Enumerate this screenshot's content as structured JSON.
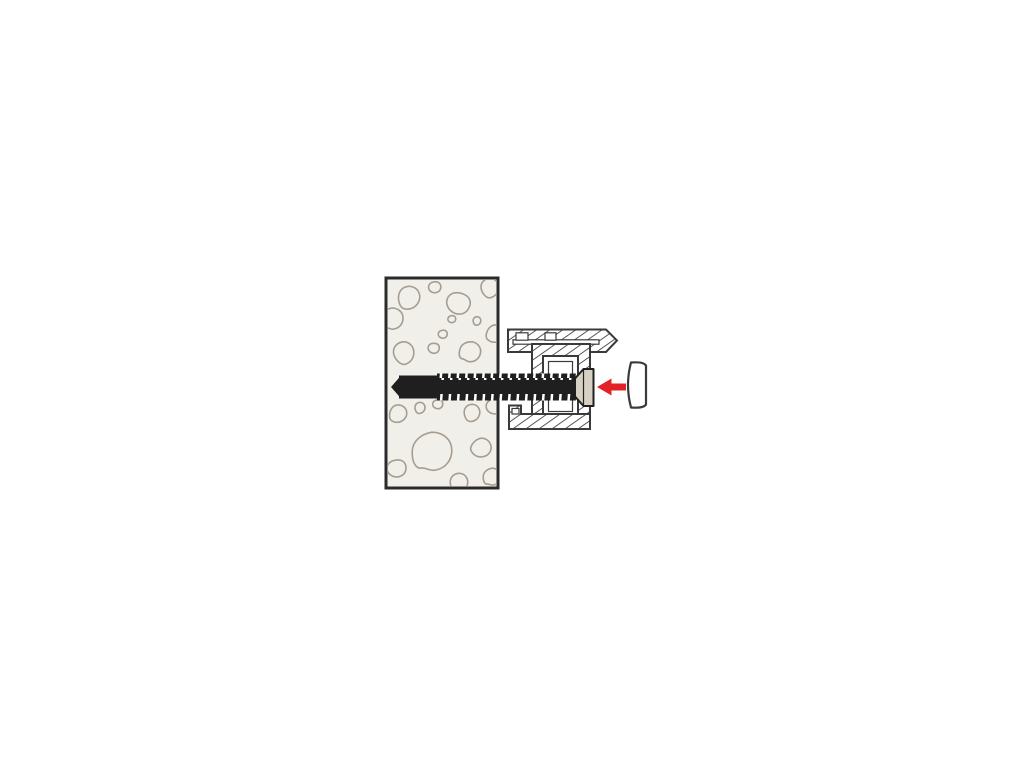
{
  "canvas": {
    "width": 1024,
    "height": 768,
    "background": "#ffffff"
  },
  "colors": {
    "wall-fill": "#f1efe9",
    "wall-border": "#2b2b2b",
    "stone-line": "#a69d90",
    "profile-line": "#3a3a3a",
    "screw-dark": "#1f1f1f",
    "screw-head": "#d6cfc2",
    "arrow-red": "#e32228",
    "cap-fill": "#ffffff"
  },
  "figure": {
    "type": "installation-diagram",
    "parts": [
      {
        "id": "wall",
        "label": "concrete-wall-cross-section"
      },
      {
        "id": "frame-profile",
        "label": "window-frame-profile-cross-section"
      },
      {
        "id": "screw",
        "label": "frame-screw-with-countersunk-head"
      },
      {
        "id": "direction-arrow",
        "label": "red-insertion-arrow"
      },
      {
        "id": "cover-cap",
        "label": "cover-cap"
      }
    ]
  }
}
